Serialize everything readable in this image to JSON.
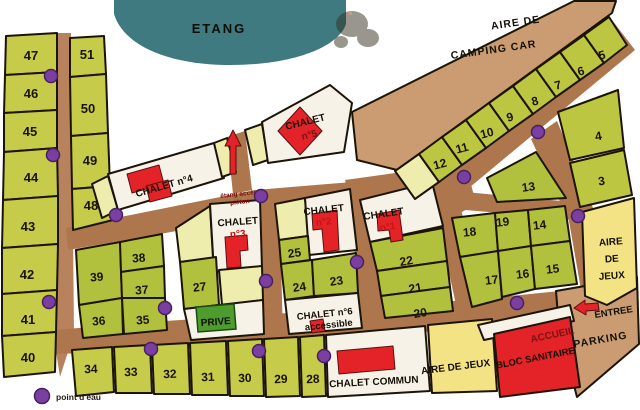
{
  "areas": {
    "etang": "ETANG",
    "camping_car_1": "AIRE  DE",
    "camping_car_2": "CAMPING CAR",
    "aire_jeux_right_1": "AIRE",
    "aire_jeux_right_2": "DE",
    "aire_jeux_right_3": "JEUX",
    "aire_jeux_bottom": "AIRE DE JEUX",
    "bloc_sanitaire": "BLOC SANITAIRE",
    "accueil": "ACCUEIL",
    "parking": "PARKING",
    "entree": "ENTREE",
    "prive": "PRIVE",
    "etang_access_1": "étang accès",
    "etang_access_2": "piéton",
    "chalet_commun": "CHALET COMMUN"
  },
  "chalets": {
    "c1_name": "CHALET",
    "c1_num": "n°1",
    "c2_name": "CHALET",
    "c2_num": "n°2",
    "c3_name": "CHALET",
    "c3_num": "n°3",
    "c4_label": "CHALET n°4",
    "c5_name": "CHALET",
    "c5_num": "n°5",
    "c6_line1": "CHALET n°6",
    "c6_line2": "accessible"
  },
  "legend": {
    "water_point_label": "point d'eau"
  },
  "plots": {
    "p3": "3",
    "p4": "4",
    "p5": "5",
    "p6": "6",
    "p7": "7",
    "p8": "8",
    "p9": "9",
    "p10": "10",
    "p11": "11",
    "p12": "12",
    "p13": "13",
    "p14": "14",
    "p15": "15",
    "p16": "16",
    "p17": "17",
    "p18": "18",
    "p19": "19",
    "p20": "20",
    "p21": "21",
    "p22": "22",
    "p23": "23",
    "p24": "24",
    "p25": "25",
    "p27": "27",
    "p28": "28",
    "p29": "29",
    "p30": "30",
    "p31": "31",
    "p32": "32",
    "p33": "33",
    "p34": "34",
    "p35": "35",
    "p36": "36",
    "p37": "37",
    "p38": "38",
    "p39": "39",
    "p40": "40",
    "p41": "41",
    "p42": "42",
    "p43": "43",
    "p44": "44",
    "p45": "45",
    "p46": "46",
    "p47": "47",
    "p48": "48",
    "p49": "49",
    "p50": "50",
    "p51": "51"
  },
  "colors": {
    "road": "#ad764c",
    "plot_green": "#c6cb49",
    "plot_olive": "#b2c13d",
    "plot_pale": "#efedae",
    "play_area_yellow": "#f4e384",
    "camping_tan": "#cb9c72",
    "pond_teal": "#3e7a80",
    "building_red": "#e42328",
    "private_green": "#4e9b2e",
    "water_point_purple": "#7b3fa1"
  }
}
